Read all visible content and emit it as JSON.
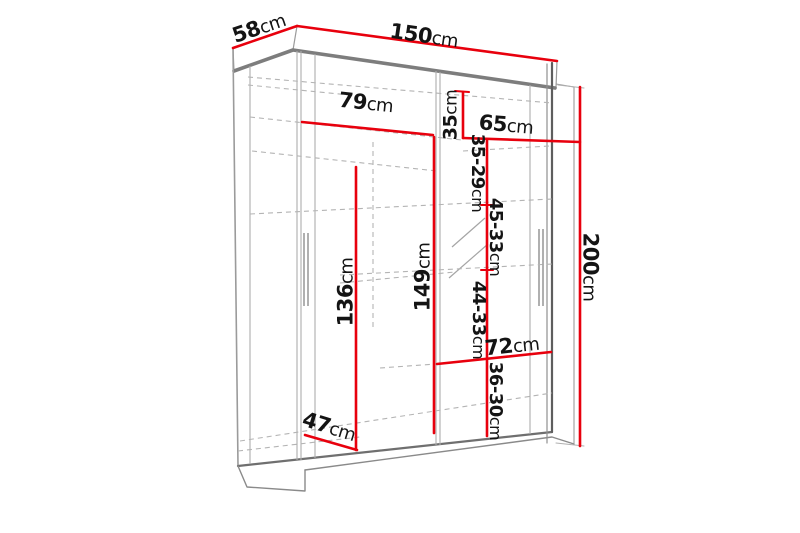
{
  "diagram": {
    "subject": "sliding-door wardrobe dimension drawing",
    "unit": "cm",
    "colors": {
      "dimension_line": "#e8000d",
      "text": "#141414",
      "outline_dark": "#6f6f6f",
      "outline_light": "#adadad",
      "background": "#ffffff"
    },
    "dimensions": [
      {
        "id": "depth",
        "num": "58",
        "unit": "cm"
      },
      {
        "id": "width",
        "num": "150",
        "unit": "cm"
      },
      {
        "id": "left-section-width",
        "num": "79",
        "unit": "cm"
      },
      {
        "id": "top-shelf-height",
        "num": "35",
        "unit": "cm"
      },
      {
        "id": "right-section-width",
        "num": "65",
        "unit": "cm"
      },
      {
        "id": "shelf-gap-1",
        "num": "35-29",
        "unit": "cm"
      },
      {
        "id": "shelf-gap-2",
        "num": "45-33",
        "unit": "cm"
      },
      {
        "id": "hanging-height",
        "num": "136",
        "unit": "cm"
      },
      {
        "id": "left-section-height",
        "num": "149",
        "unit": "cm"
      },
      {
        "id": "shelf-gap-3",
        "num": "44-33",
        "unit": "cm"
      },
      {
        "id": "shelf-width",
        "num": "72",
        "unit": "cm"
      },
      {
        "id": "shelf-gap-4",
        "num": "36-30",
        "unit": "cm"
      },
      {
        "id": "bottom-left-width",
        "num": "47",
        "unit": "cm"
      },
      {
        "id": "total-height",
        "num": "200",
        "unit": "cm"
      }
    ]
  }
}
